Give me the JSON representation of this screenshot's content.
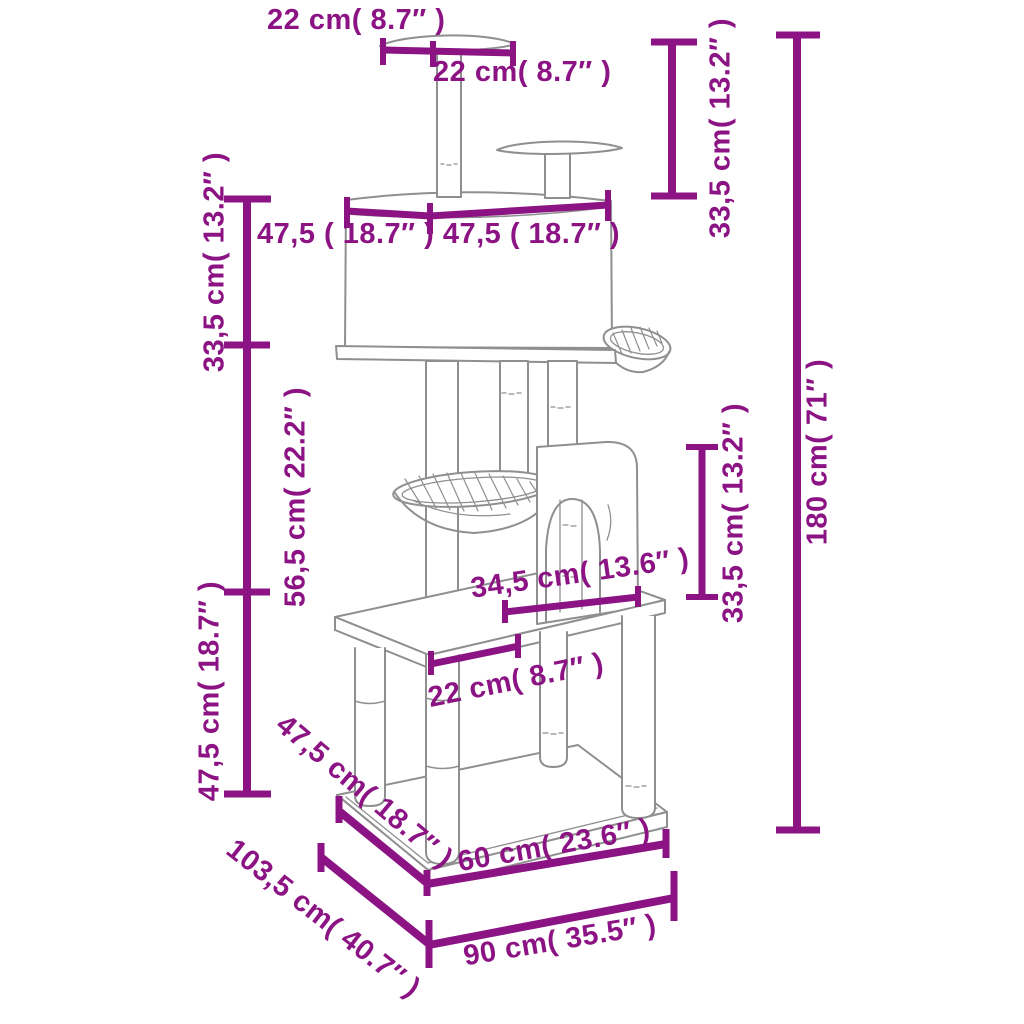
{
  "diagram": {
    "type": "product-dimension-diagram",
    "subject": "cat tree tower with scratching posts, condos, perches and baskets",
    "colors": {
      "dimension_accent": "#8C1383",
      "line_art": "#8F8F8F",
      "background": "#FFFFFF"
    },
    "labels": {
      "top_shelf_width": "22 cm( 8.7″ )",
      "top_shelf_width_2": "22 cm( 8.7″ )",
      "upper_section_height": "33,5 cm( 13.2″ )",
      "condo_width": "47,5 ( 18.7″ ) 47,5 ( 18.7″ )",
      "condo_height": "33,5 cm( 13.2″ )",
      "middle_section_height": "56,5 cm( 22.2″ )",
      "lower_section_height": "47,5 cm( 18.7″ )",
      "shelf_depth": "34,5 cm( 13.6″ )",
      "shelf_front_width": "22 cm( 8.7″ )",
      "lower_house_height": "33,5 cm( 13.2″ )",
      "total_height": "180 cm( 71″ )",
      "base_side_depth": "47,5 cm( 18.7″ )",
      "overall_depth": "103,5 cm( 40.7″ )",
      "base_front_width": "60 cm( 23.6″ )",
      "overall_width": "90 cm( 35.5″ )"
    }
  }
}
